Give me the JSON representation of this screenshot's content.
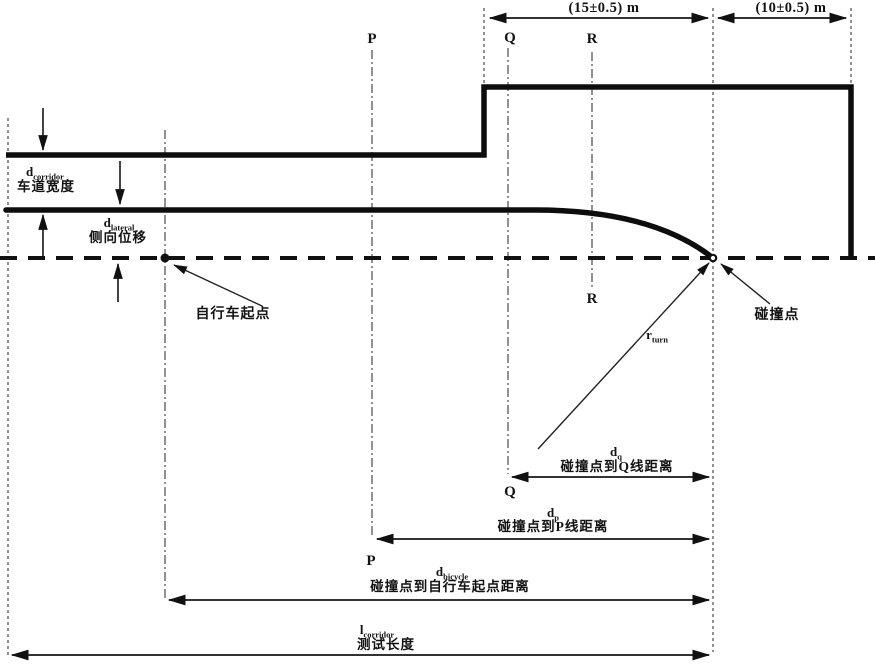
{
  "background": "#ffffff",
  "ink": "#111111",
  "top_dimensions": {
    "left_span": "(15±0.5) m",
    "right_span": "(10±0.5) m"
  },
  "reference_lines": {
    "p": "P",
    "q": "Q",
    "r": "R"
  },
  "labels": {
    "corridor_width": {
      "base": "d",
      "sub": "corridor",
      "cn": "车道宽度"
    },
    "lateral_offset": {
      "base": "d",
      "sub": "lateral",
      "cn": "侧向位移"
    },
    "bicycle_start": {
      "cn": "自行车起点"
    },
    "collision_point": {
      "cn": "碰撞点"
    },
    "turn_radius": {
      "base": "r",
      "sub": "turn"
    },
    "dist_to_q": {
      "base": "d",
      "sub": "q",
      "cn": "碰撞点到Q线距离"
    },
    "dist_to_p": {
      "base": "d",
      "sub": "p",
      "cn": "碰撞点到P线距离"
    },
    "dist_to_bicycle_start": {
      "base": "d",
      "sub": "bicycle",
      "cn": "碰撞点到自行车起点距离"
    },
    "test_length": {
      "base": "l",
      "sub": "corridor",
      "cn": "测试长度"
    }
  }
}
